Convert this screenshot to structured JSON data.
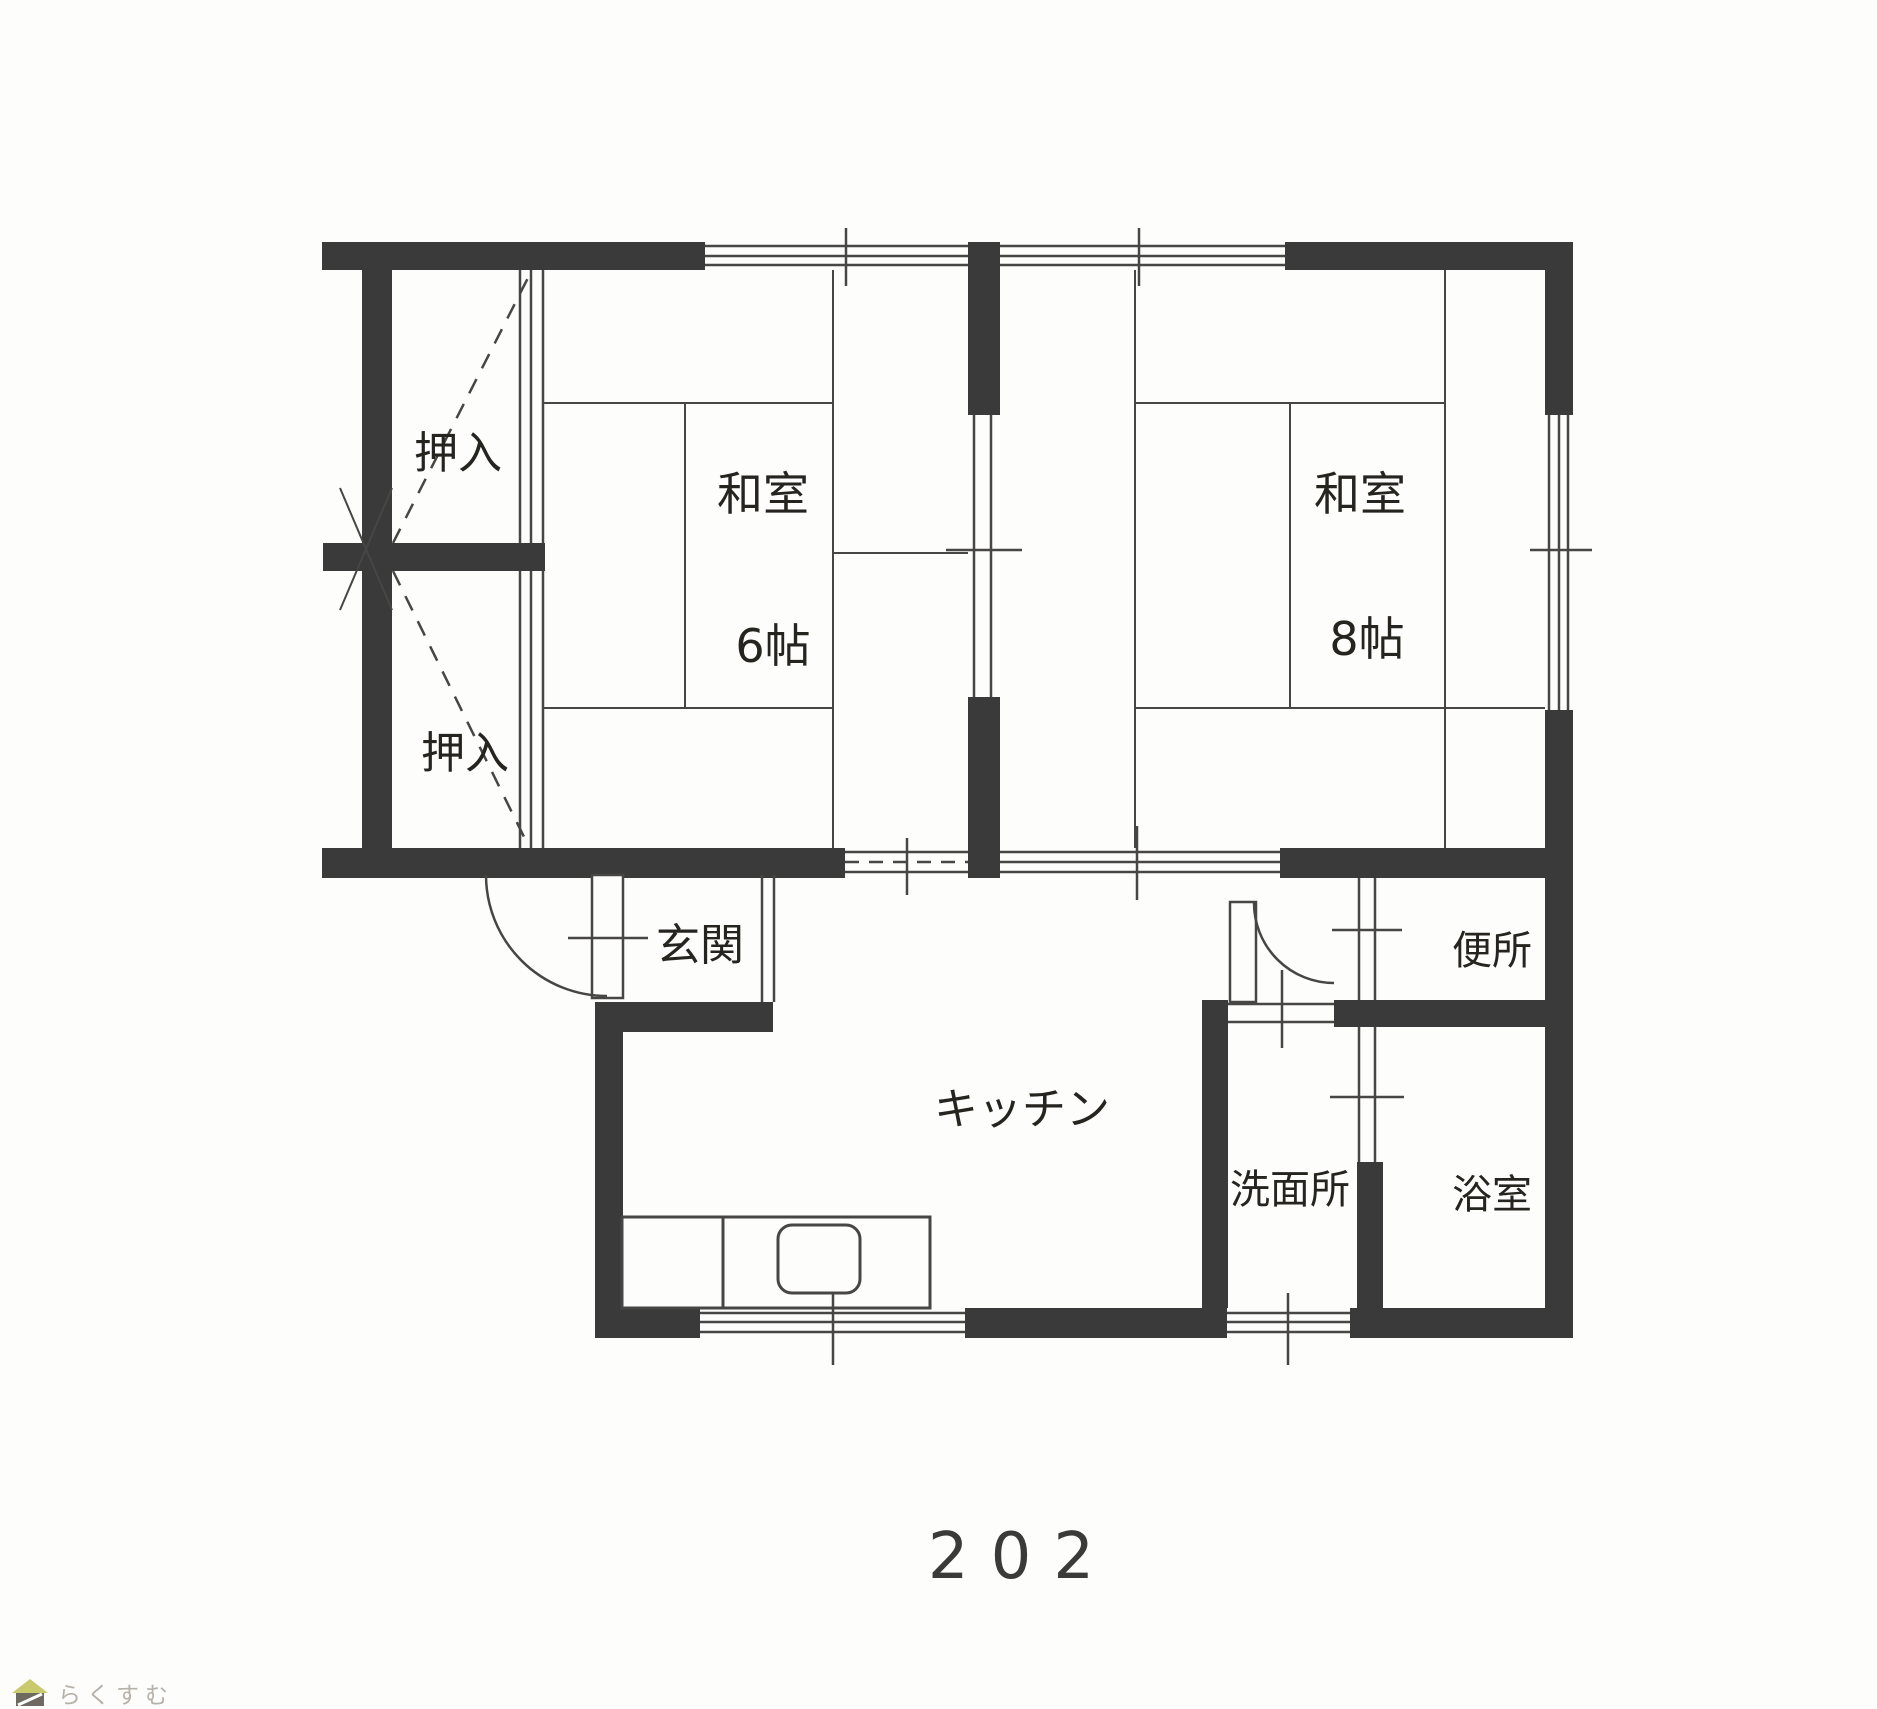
{
  "document": {
    "type": "floor-plan-scan",
    "unit_number": "202",
    "colors": {
      "wall": "#3a3a3a",
      "line": "#474644",
      "text": "#26241f",
      "paper": "#fdfdfc",
      "watermark_text": "#b6b1a9",
      "watermark_roof": "#c9ca6c",
      "watermark_body": "#6e6a62"
    }
  },
  "rooms": [
    {
      "id": "oshiire-upper",
      "label": "押入"
    },
    {
      "id": "oshiire-lower",
      "label": "押入"
    },
    {
      "id": "washitsu-6",
      "label": "和室",
      "size": "6帖"
    },
    {
      "id": "washitsu-8",
      "label": "和室",
      "size": "8帖"
    },
    {
      "id": "genkan",
      "label": "玄関"
    },
    {
      "id": "kitchen",
      "label": "キッチン"
    },
    {
      "id": "benjo",
      "label": "便所"
    },
    {
      "id": "senmenjo",
      "label": "洗面所"
    },
    {
      "id": "yokushitsu",
      "label": "浴室"
    }
  ],
  "watermark": {
    "brand": "らくすむ"
  }
}
